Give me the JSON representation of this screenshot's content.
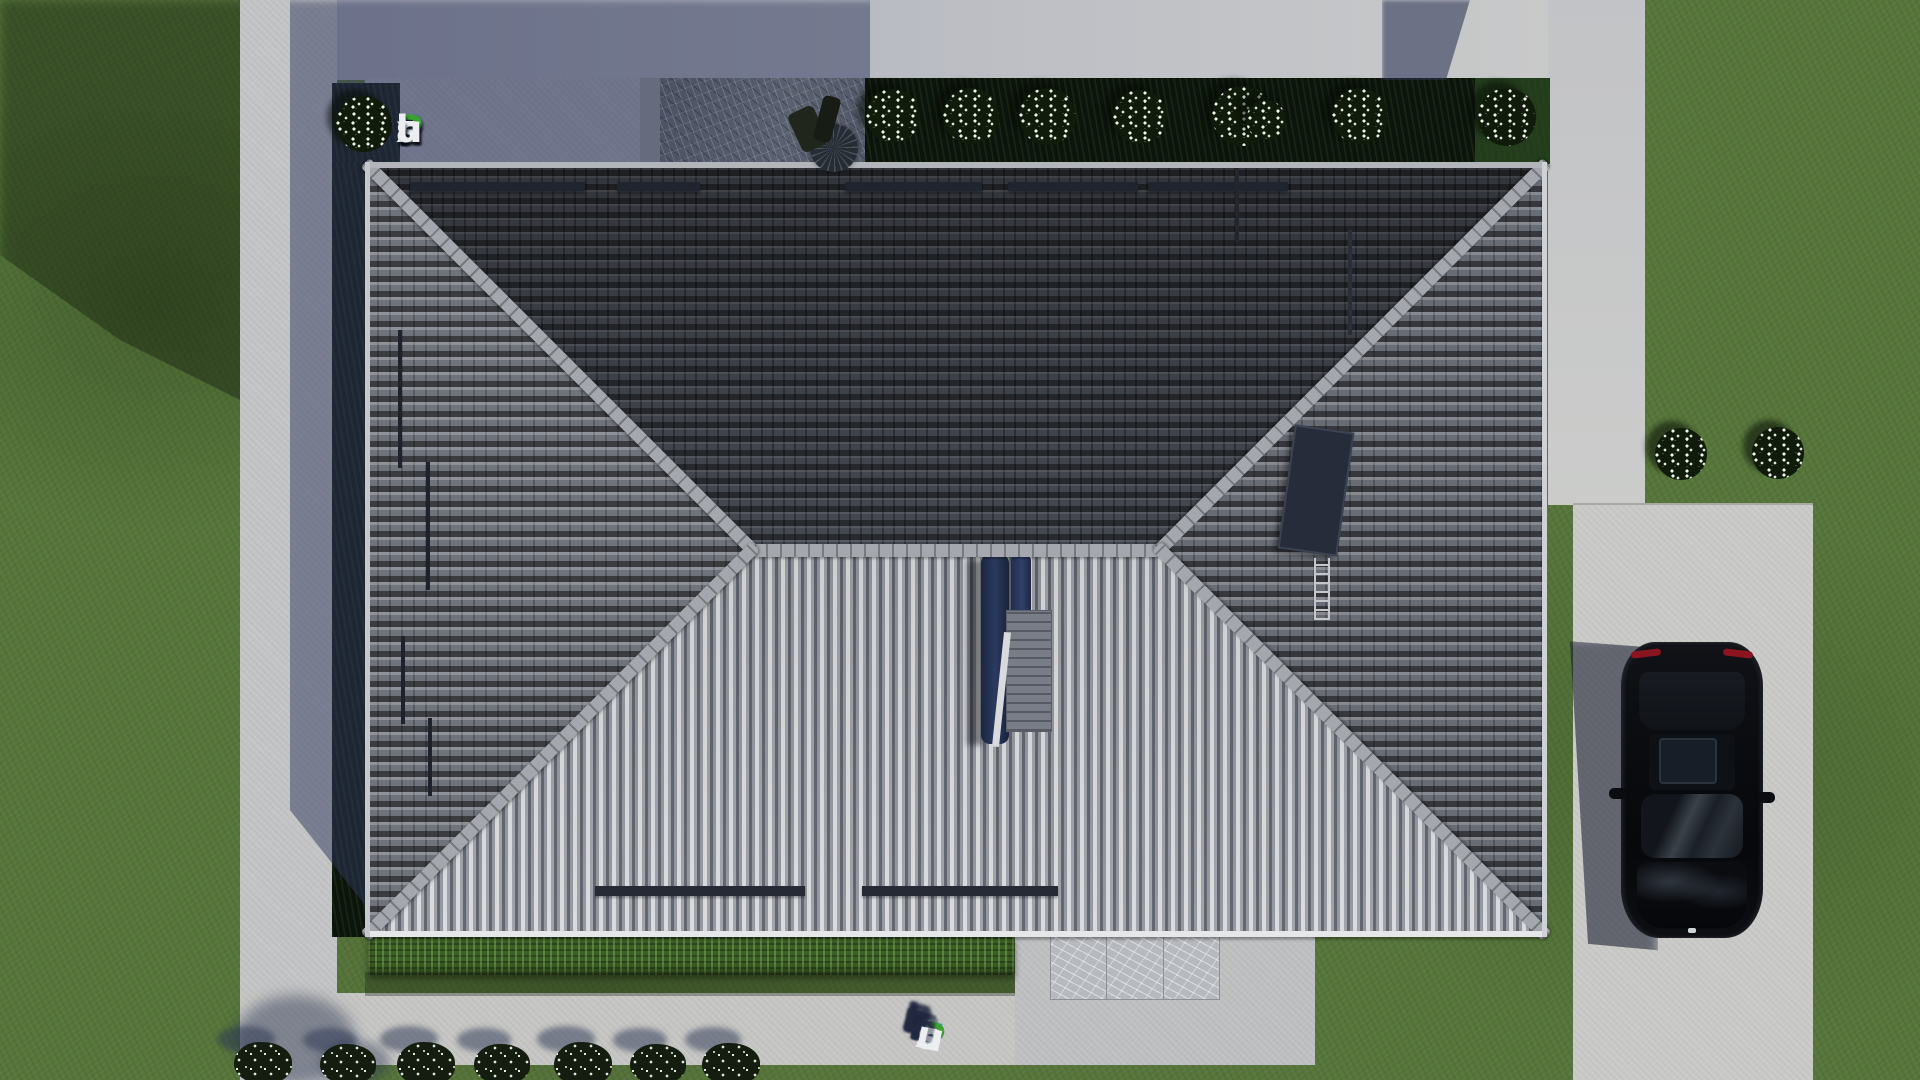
{
  "brand": {
    "text": "FixPlans.ru",
    "logo_letters": [
      [
        "F",
        "blue"
      ],
      [
        "i",
        "white"
      ],
      [
        "x",
        "white"
      ],
      [
        "P",
        "green"
      ],
      [
        "l",
        "white"
      ],
      [
        "a",
        "white"
      ],
      [
        "n",
        "white"
      ],
      [
        "s",
        "white"
      ],
      [
        ".",
        "dotblue"
      ],
      [
        "r",
        "white"
      ],
      [
        "u",
        "white"
      ]
    ],
    "watermark_letters": [
      [
        "F",
        "skyblue"
      ],
      [
        "i",
        "green"
      ],
      [
        "x",
        "white"
      ],
      [
        "P",
        "green"
      ],
      [
        "l",
        "white"
      ],
      [
        "a",
        "white"
      ],
      [
        "n",
        "white"
      ],
      [
        "s",
        "white"
      ],
      [
        ".",
        "skyblue"
      ],
      [
        "r",
        "white"
      ],
      [
        "u",
        "white"
      ]
    ]
  },
  "colors": {
    "blue": "#2d6bd4",
    "dotblue": "#2454c4",
    "skyblue": "#31a2e4",
    "green": "#3aa32f",
    "white": "#eceef2",
    "grass": "#57763b",
    "pavement": "#c6c6c4",
    "roof_dark": "#474b54",
    "roof_light": "#d8d9dc",
    "car_body": "#0a0c10"
  },
  "scene": {
    "type": "aerial-top-view-architectural-render",
    "house": "hip-roof-residence",
    "vehicle": "black-car-on-driveway",
    "vegetation": [
      "lawn",
      "hedge",
      "white-flower-bushes",
      "border-plants"
    ],
    "hardscape": [
      "perimeter-walkway",
      "driveway",
      "stone-patio",
      "marble-patio"
    ]
  }
}
